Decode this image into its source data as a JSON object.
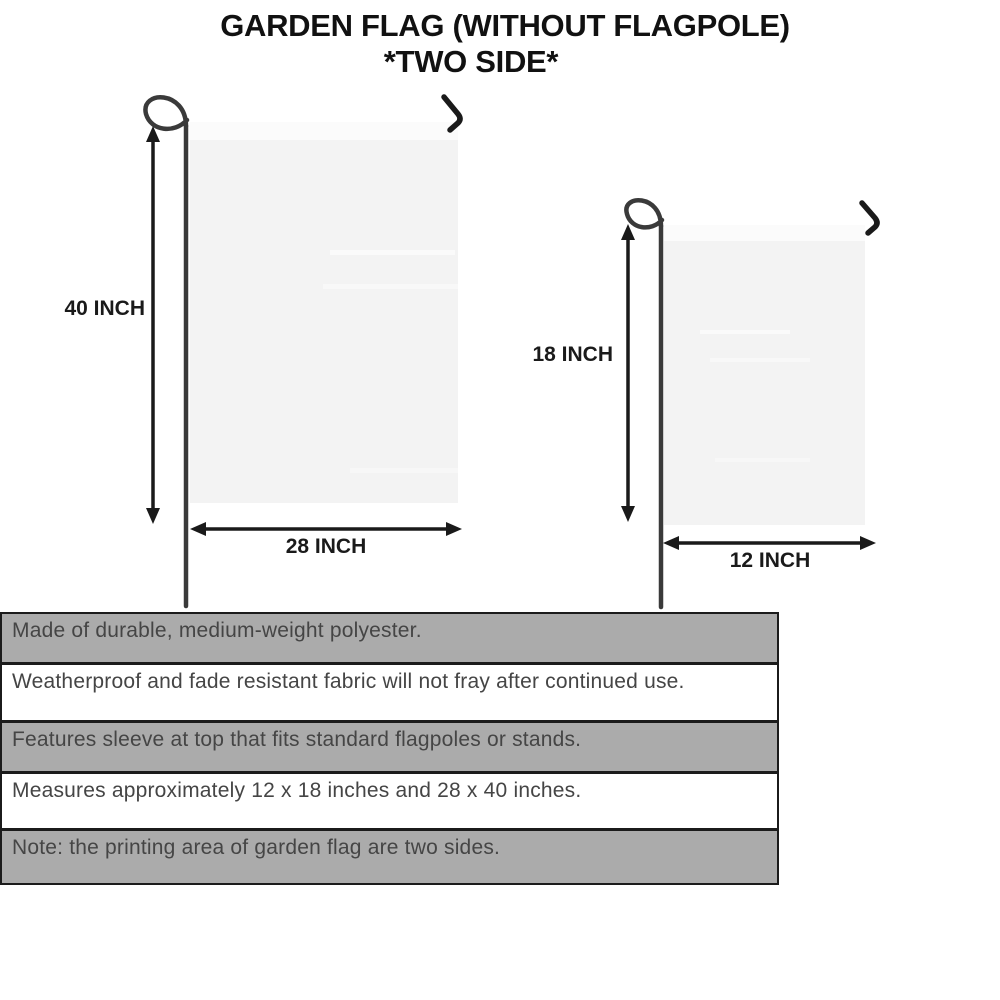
{
  "title": {
    "line1": "GARDEN FLAG (WITHOUT FLAGPOLE)",
    "line2": "*TWO SIDE*"
  },
  "flags": {
    "large": {
      "name": "large garden flag",
      "height_label": "40 INCH",
      "width_label": "28 INCH"
    },
    "small": {
      "name": "small garden flag",
      "height_label": "18 INCH",
      "width_label": "12 INCH"
    }
  },
  "features": [
    "Made of durable, medium-weight polyester.",
    "Weatherproof and fade resistant fabric will not fray after continued use.",
    "Features sleeve at top that fits standard flagpoles or stands.",
    "Measures approximately 12 x 18 inches and 28 x 40 inches.",
    "Note: the printing area of garden flag are two sides."
  ],
  "colors": {
    "background": "#ffffff",
    "row_gray": "#ababab",
    "row_white": "#ffffff",
    "table_border": "#1b1b1b",
    "flag_fill": "#f3f3f3",
    "flag_sleeve": "#fbfbfb",
    "pole": "#3a3a3a",
    "hook": "#1a1a1a",
    "arrow": "#1a1a1a",
    "title_text": "#111111",
    "feature_text": "#454545"
  }
}
